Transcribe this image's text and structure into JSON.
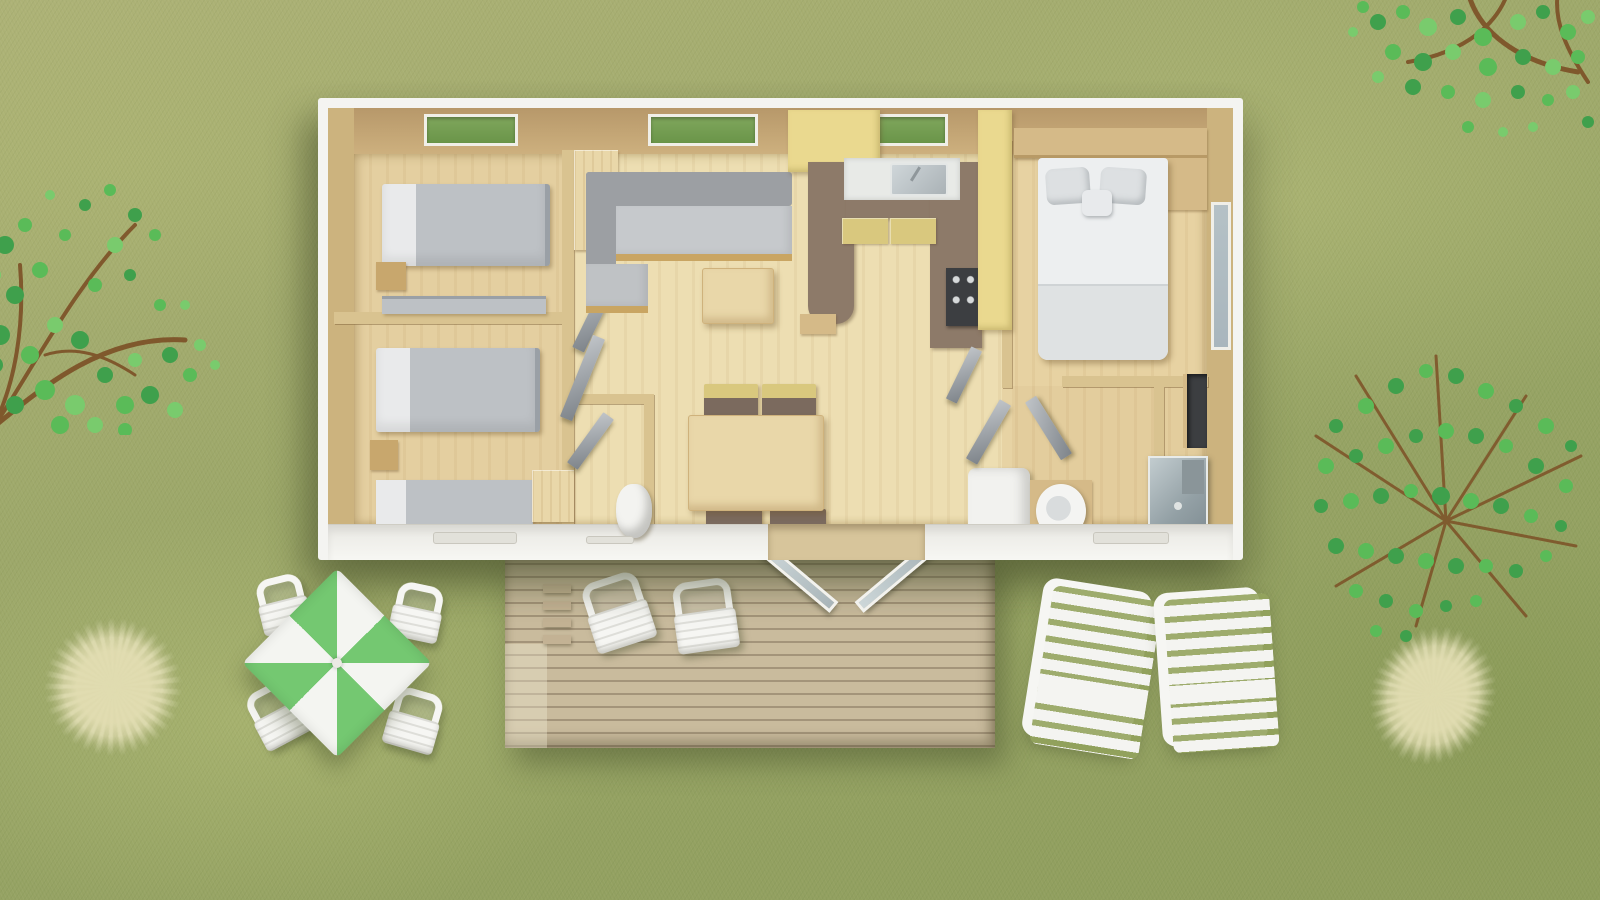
{
  "scene": {
    "type": "aerial-3d-floorplan-render",
    "setting": "mobile-home bungalow on a grass campsite pitch"
  },
  "palette": {
    "grassA": "#adb276",
    "grassB": "#8e9d5c",
    "white": "#f4f4f1",
    "wallFaceDark": "#b7986a",
    "wallFace": "#cdb07e",
    "wallBand": "#ccb37e",
    "wallInner": "#d9c390",
    "floor": "#e7d3a4",
    "floorMid": "#eddeb2",
    "floorBed": "#e4cfa0",
    "floorMaster": "#e7d2a2",
    "floorBath": "#e3cd9d",
    "woodLight": "#e9d7a9",
    "wood": "#d5ba88",
    "woodDark": "#c8a76d",
    "trim": "#c9a562",
    "sofaDark": "#9c9fa3",
    "sofaLight": "#c6c9cc",
    "bedGray": "#bdc1c5",
    "sheet": "#e9eaeb",
    "brown": "#8d7a69",
    "yellow": "#ead98f",
    "khaki": "#d9c87e",
    "steel": "#b9c1c5",
    "dark": "#3c3e41",
    "glassTop": "#7fa65c",
    "glassBottom": "#6a9549",
    "glassBlue": "#a9b6bd",
    "deck": "#c9bb9d",
    "parasolGreen": "#74c871",
    "chairWhite": "#f6f6f3",
    "leaf1": "#3fa04c",
    "leaf2": "#5abb58",
    "leaf3": "#79cb6d",
    "branch": "#7c5026",
    "dry": "#d9d3a8"
  },
  "house": {
    "rooms": [
      {
        "name": "twin-bedroom-1",
        "furniture": [
          "single-bed",
          "single-bed",
          "nightstand",
          "skylight-window"
        ]
      },
      {
        "name": "twin-bedroom-2",
        "furniture": [
          "single-bed",
          "single-bed",
          "nightstand",
          "small-cabinet"
        ]
      },
      {
        "name": "wc",
        "furniture": [
          "toilet",
          "door"
        ]
      },
      {
        "name": "living-room",
        "furniture": [
          "corner-sofa",
          "coffee-table",
          "dining-table",
          "dining-chair-x4",
          "skylight-window"
        ]
      },
      {
        "name": "kitchen",
        "furniture": [
          "u-shaped-counter",
          "sink",
          "faucet",
          "stove-4-burners",
          "overhead-cabinet",
          "tall-cabinet",
          "skylight-window"
        ]
      },
      {
        "name": "master-bedroom",
        "furniture": [
          "double-bed",
          "pillow-x2",
          "cushion",
          "headboard-shelf",
          "nightstand",
          "side-window",
          "wardrobe"
        ]
      },
      {
        "name": "bathroom",
        "furniture": [
          "shower-cabin",
          "washbasin",
          "water-heater",
          "door-x2"
        ]
      }
    ]
  },
  "outdoor": {
    "deck": {
      "items": [
        "wood-plank-terrace",
        "steps",
        "deck-chair",
        "deck-chair",
        "open-double-glass-doors"
      ]
    },
    "patio_set": {
      "items": [
        "green-white-parasol-table",
        "garden-chair",
        "garden-chair",
        "garden-chair",
        "garden-chair"
      ]
    },
    "loungers": [
      "sun-lounger",
      "sun-lounger"
    ],
    "vegetation": [
      "tree-top-left",
      "tree-top-right",
      "tree-right",
      "dry-grass-tuft-bottom-left",
      "dry-grass-tuft-bottom-right"
    ]
  }
}
